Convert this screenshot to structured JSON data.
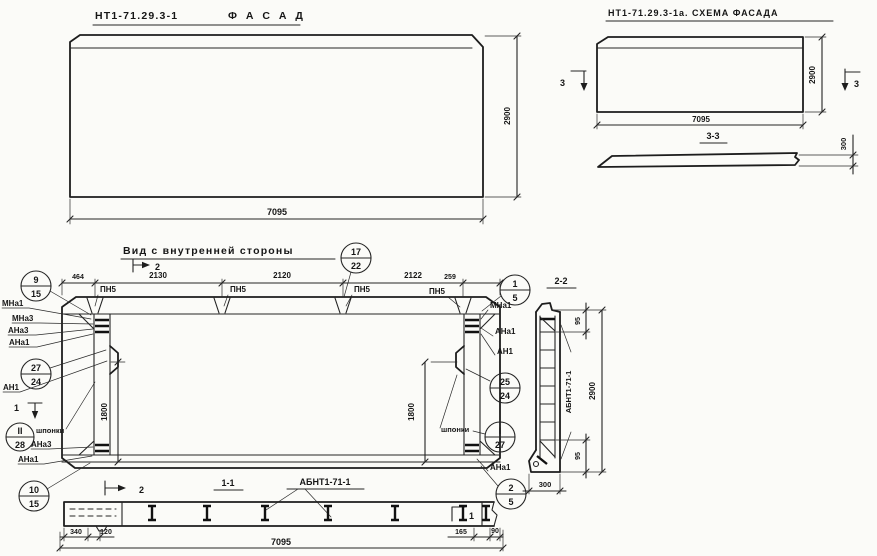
{
  "facade": {
    "code": "НТ1-71.29.3-1",
    "name": "Ф А С А Д",
    "dim_width": "7095",
    "dim_height": "2900"
  },
  "scheme": {
    "title": "НТ1-71.29.3-1а. СХЕМА ФАСАДА",
    "dim_width": "7095",
    "dim_height": "2900",
    "section_label": "3-3",
    "slab_dim": "300",
    "mark_left": "3",
    "mark_right": "3"
  },
  "inner": {
    "title": "Вид с внутренней стороны",
    "dims_top": {
      "a": "464",
      "b": "2130",
      "c": "2120",
      "d": "2122",
      "e": "259"
    },
    "pn": {
      "p1": "ПН5",
      "p2": "ПН5",
      "p3": "ПН5",
      "p4": "ПН5"
    },
    "dim_left_vert": "1800",
    "dim_right_vert": "1800",
    "marks": {
      "top2": "2",
      "bottom2": "2",
      "left1": "1",
      "right1": "1"
    },
    "callouts": {
      "c9": {
        "top": "9",
        "bottom": "15"
      },
      "c27": {
        "top": "27",
        "bottom": "24"
      },
      "c11": {
        "top": "II",
        "bottom": "28"
      },
      "c10": {
        "top": "10",
        "bottom": "15"
      },
      "c17": {
        "top": "17",
        "bottom": "22"
      },
      "c1": {
        "top": "1",
        "bottom": "5"
      },
      "c25": {
        "top": "25",
        "bottom": "24"
      },
      "cI": {
        "top": "I",
        "bottom": "27"
      },
      "c2": {
        "top": "2",
        "bottom": "5"
      }
    },
    "labels": {
      "mna1_l": "МНа1",
      "mna3_l": "МНа3",
      "ana3_l": "АНа3",
      "ana1_l": "АНа1",
      "an1_l": "АН1",
      "shponki_l": "шпонки",
      "ana3_l2": "АНа3",
      "ana1_l2": "АНа1",
      "mna1_r": "МНа1",
      "ana1_r": "АНа1",
      "an1_r": "АН1",
      "shponki_r": "шпонки",
      "ana1_r2": "АНа1"
    }
  },
  "section11": {
    "label": "1-1",
    "part": "АБНТ1-71-1",
    "d340": "340",
    "d120": "120",
    "d165": "165",
    "d90": "90",
    "total": "7095"
  },
  "section22": {
    "label": "2-2",
    "part": "АБНТ1-71-1",
    "top": "95",
    "bottom": "95",
    "height": "2900",
    "width": "300"
  }
}
